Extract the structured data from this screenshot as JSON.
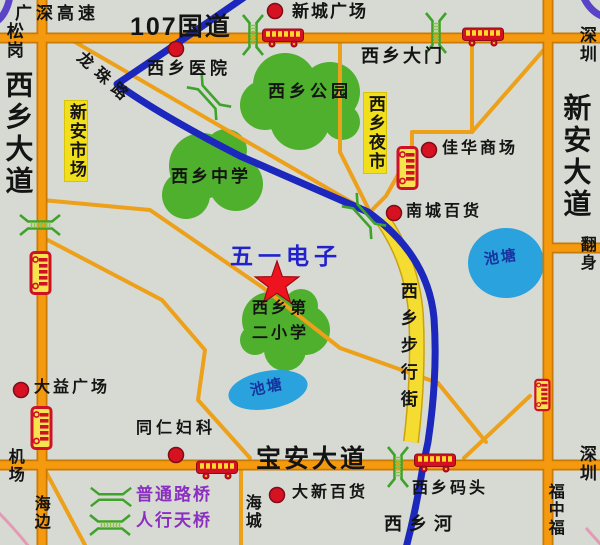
{
  "roads": {
    "guangshen": "广深高速",
    "g107": "107国道",
    "longzhu": "龙珠路",
    "xixiang_ave": "西乡大道",
    "xinan_ave": "新安大道",
    "baoan_ave": "宝安大道",
    "ped_street": "西乡步行街",
    "river": "西乡河",
    "fanshen": "翻身",
    "fuzhongfu": "福中福"
  },
  "dirs": {
    "songgang": "松岗",
    "shenzhen_ne": "深圳",
    "shenzhen_se": "深圳",
    "airport": "机场",
    "haibian": "海边",
    "haicheng": "海城"
  },
  "places": {
    "xincheng": "新城广场",
    "hospital": "西乡医院",
    "gate": "西乡大门",
    "park": "西乡公园",
    "xinan_market": "新安市场",
    "night_market": "西乡夜市",
    "middle_school": "西乡中学",
    "jiahua": "佳华商场",
    "nancheng": "南城百货",
    "pond_right": "池塘",
    "wuyi": "五一电子",
    "primary1": "西乡第",
    "primary2": "二小学",
    "pond_center": "池塘",
    "dayi": "大益广场",
    "tongren": "同仁妇科",
    "daxin": "大新百货",
    "wharf": "西乡码头"
  },
  "legend": {
    "ordinary": "普通路桥",
    "foot": "人行天桥"
  },
  "colors": {
    "road_orange": "#f5990e",
    "road_blue": "#1b27bd",
    "road_yellow": "#f4dd30",
    "green_area": "#4eb02c",
    "pond_blue": "#29a2de",
    "marker_red": "#d61222",
    "label_yellow": "#f2df1b",
    "legend_purple": "#8a2fc0",
    "title_blue": "#2222cc"
  }
}
